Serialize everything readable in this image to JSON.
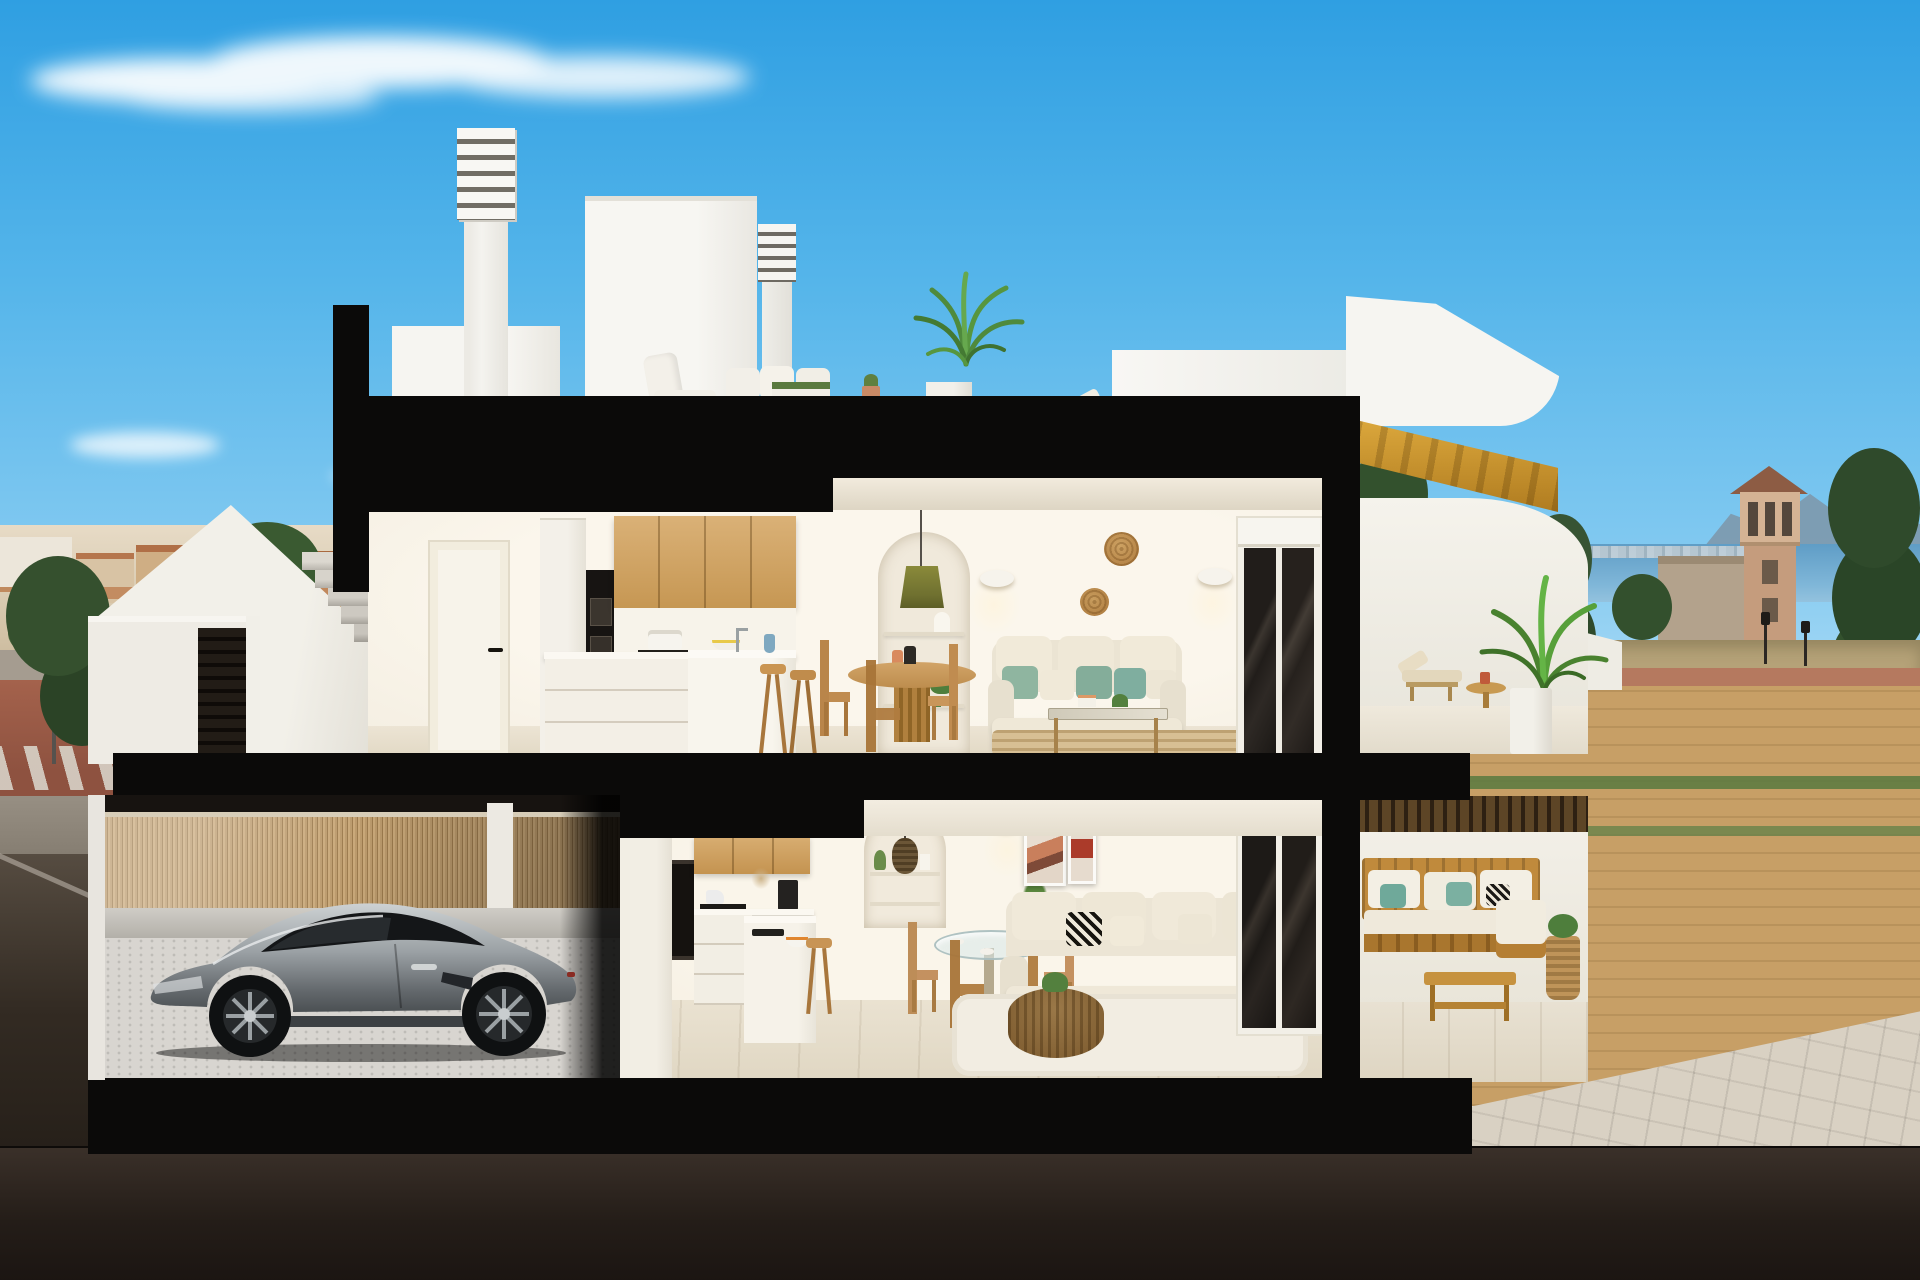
{
  "scene": {
    "setting": "3D cutaway cross-section render of a two-storey coastal townhouse with roof terrace, street-level entry and basement garage",
    "time_of_day": "day",
    "regions": {
      "sky": {
        "title": "Blue sky with wispy cloud"
      },
      "roof_terrace": {
        "title": "Roof terrace",
        "objects": [
          "louvered-chimney",
          "small-louvered-chimney",
          "stair-bulkhead",
          "white-outdoor-lounge-set",
          "grass-planter",
          "potted-palm",
          "terracotta-pot",
          "roof-lounger",
          "side-table"
        ]
      },
      "upper_floor": {
        "title": "Upper floor: kitchen, dining and living room",
        "objects": [
          "white-door",
          "fridge-column",
          "double-oven-tower",
          "oak-upper-cabinets",
          "kitchen-island",
          "bar-stools",
          "olive-pendant-lamp",
          "arched-shelf-niche",
          "round-wood-dining-table",
          "wood-dining-chairs",
          "wall-sconces",
          "rattan-wall-baskets",
          "cream-sofa-green-pillows",
          "glass-coffee-table",
          "jute-rug",
          "sliding-glass-door"
        ]
      },
      "upper_terrace": {
        "title": "Upper terrace with sea view",
        "objects": [
          "wood-staircase",
          "curved-parapet",
          "sun-lounger",
          "round-side-table",
          "potted-palm"
        ]
      },
      "entry_level": {
        "title": "Street-level entry",
        "objects": [
          "stair-parapet",
          "concrete-steps",
          "slatted-gate",
          "entry-door"
        ]
      },
      "ground_floor": {
        "title": "Ground floor apartment",
        "objects": [
          "oak-upper-cabinets",
          "oven-tower",
          "kitchen-island",
          "arched-niche-pendant",
          "glass-dining-table",
          "wood-chairs",
          "abstract-wall-art",
          "cream-sofa-bw-pillows",
          "rattan-coffee-table",
          "white-rug",
          "sliding-glass-door"
        ]
      },
      "lower_terrace": {
        "title": "Ground-floor terrace",
        "objects": [
          "slatted-pergola-shadow",
          "wooden-outdoor-sofa",
          "teal-pillows",
          "wooden-coffee-table"
        ]
      },
      "garage": {
        "title": "Basement garage",
        "objects": [
          "silver-sports-coupe",
          "bamboo-slat-fence",
          "paver-floor"
        ]
      },
      "background_left": {
        "title": "Town skyline with terracotta roofs, pines, street with crosswalk and blue sign"
      },
      "background_right": {
        "title": "Sea horizon, watchtower, mountains, conifers, lamp posts and paver path"
      }
    },
    "palette": {
      "sky_top": "#3aa7e6",
      "sky_horizon": "#d8eefa",
      "cloud": "#ffffff",
      "cut_black": "#0b0a09",
      "wall_white": "#f5f1e7",
      "soffit": "#e9e2d3",
      "oak_wood": "#d0a868",
      "stair_wood": "#cf9a33",
      "floor_beige": "#e9e1d0",
      "sofa_cream": "#ece5d4",
      "pillow_green": "#8fb5a0",
      "pillow_teal": "#6fa99a",
      "basket_rattan": "#bd8a4c",
      "fence_bamboo": "#b7946a",
      "car_silver": "#9aa0a4",
      "sea": "#62a2c8",
      "mountain": "#7d98ac",
      "tower_tan": "#c59c7d",
      "roof_terracotta": "#bd7a4d",
      "street_red": "#a2604b",
      "ground_tan": "#c7a067",
      "grass": "#5e7b41",
      "path_gray": "#d9d2c4",
      "road_dark": "#241d18"
    }
  }
}
